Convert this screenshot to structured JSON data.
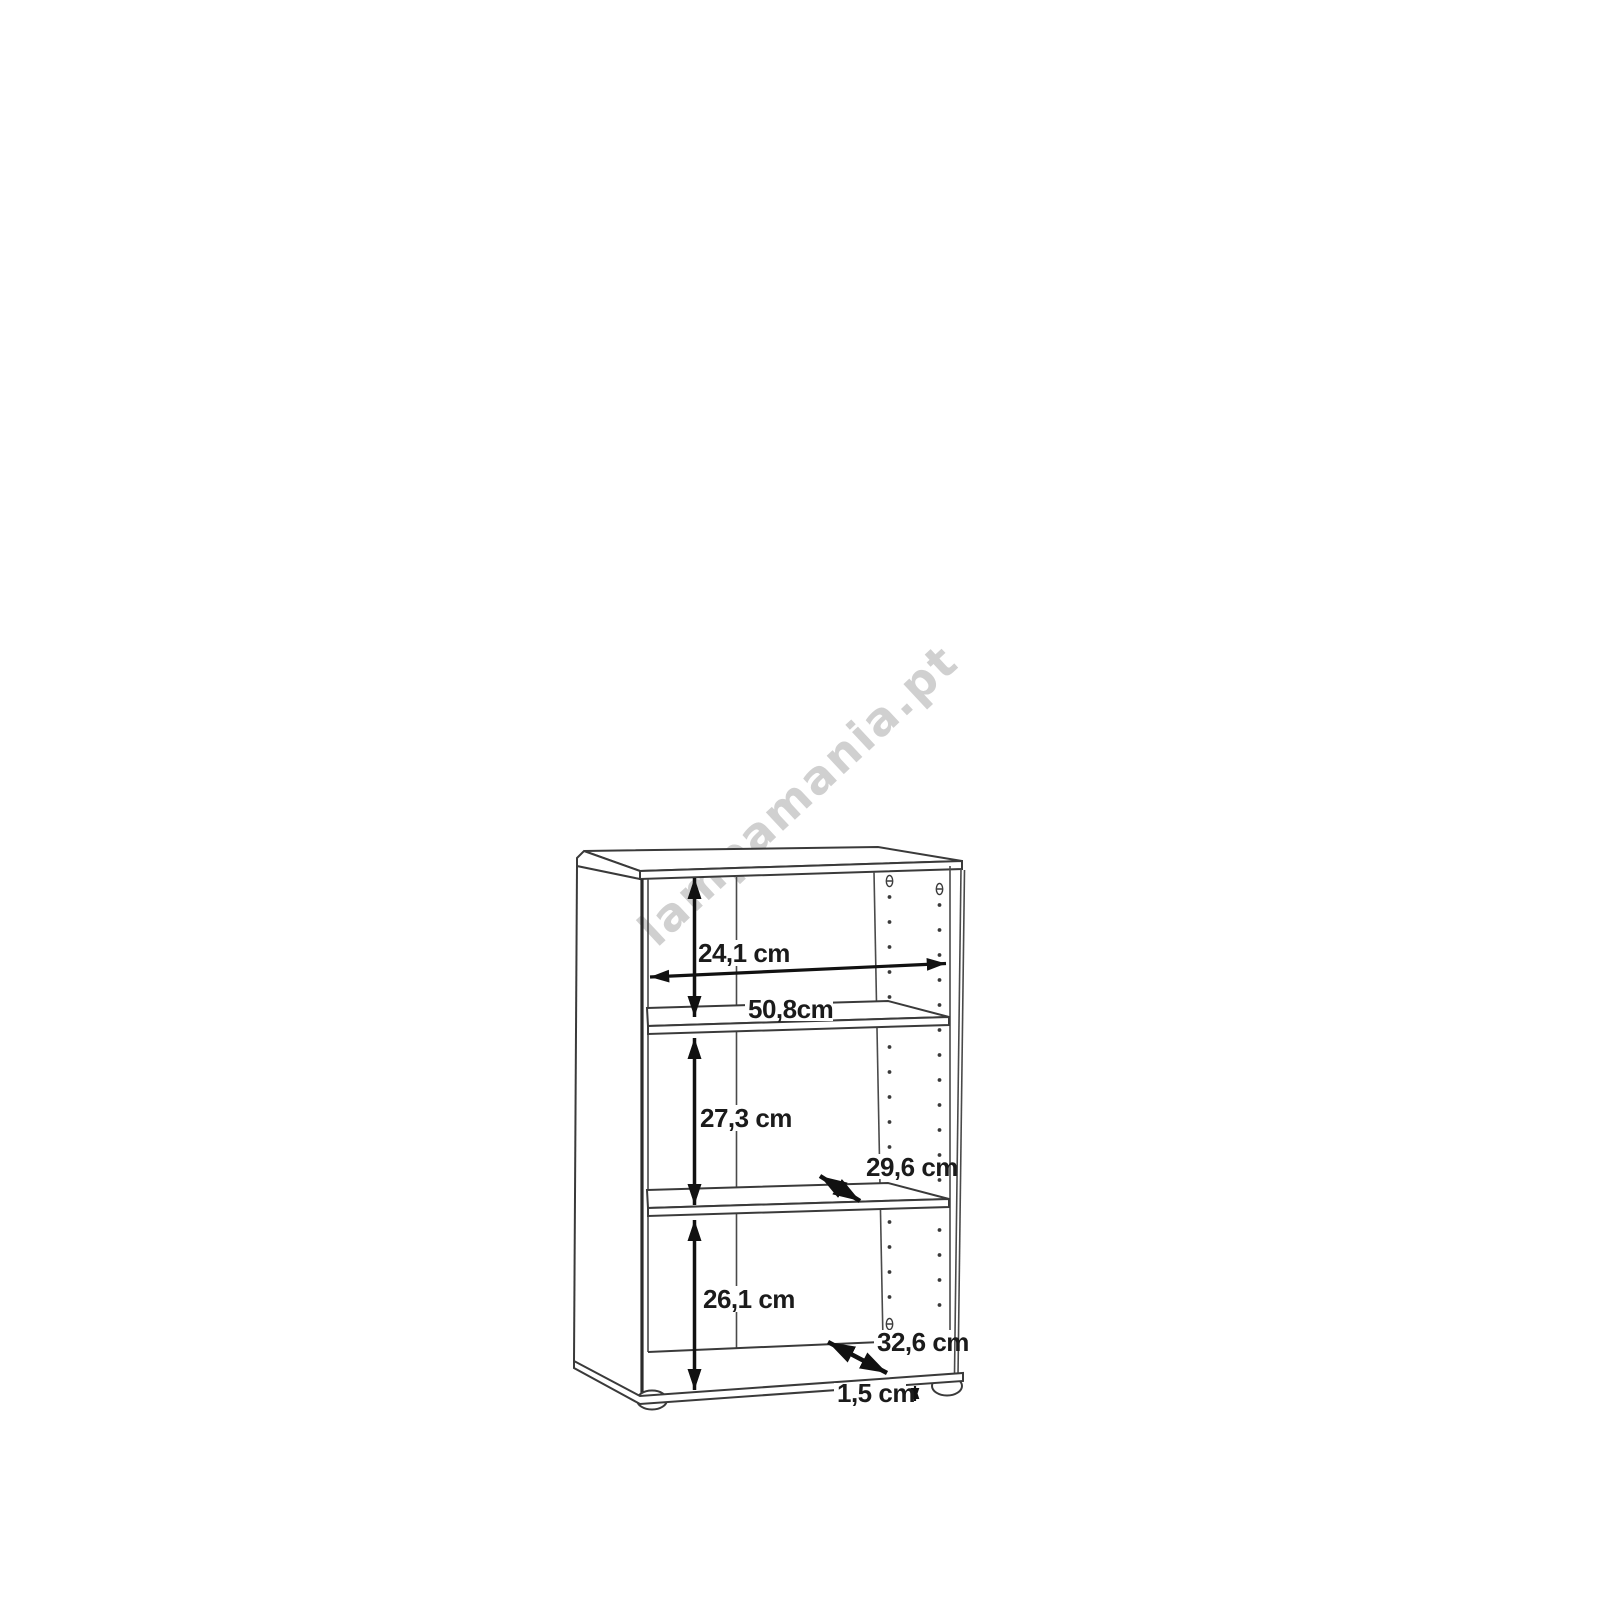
{
  "watermark": {
    "text": "lampamania.pt",
    "color": "#d0d0d0"
  },
  "diagram": {
    "kind": "bookcase dimension drawing",
    "colors": {
      "background": "#ffffff",
      "line": "#3a3a3a",
      "dimension_arrows": "#111111",
      "label_text": "#1b1b1b"
    },
    "dimensions": {
      "top_compartment_height": "24,1 cm",
      "inner_width": "50,8cm",
      "middle_compartment_height": "27,3 cm",
      "shelf_depth": "29,6 cm",
      "bottom_compartment_height": "26,1 cm",
      "bottom_depth": "32,6 cm",
      "foot_height": "1,5 cm"
    }
  }
}
